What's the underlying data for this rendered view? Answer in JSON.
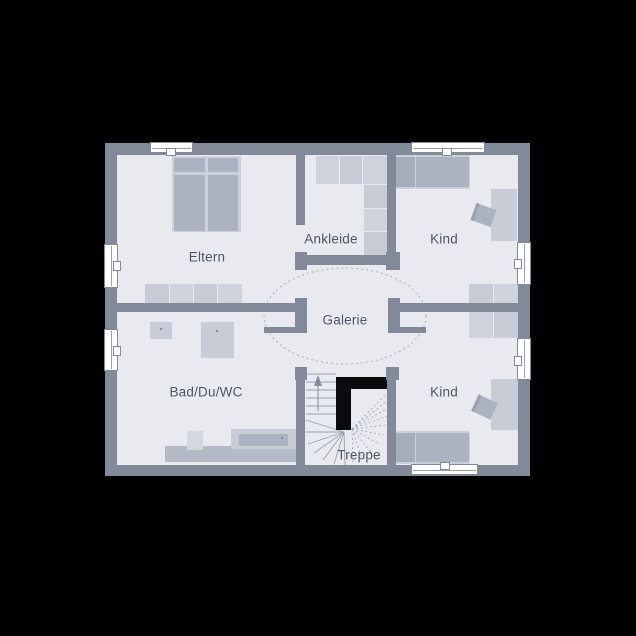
{
  "canvas": {
    "width": 636,
    "height": 636,
    "background": "#000000"
  },
  "plan": {
    "left": 105,
    "top": 143,
    "width": 425,
    "height": 333,
    "wall_thickness": 12,
    "colors": {
      "wall": "#828a99",
      "room": "#e8eaef",
      "furniture": "#c7ccd7",
      "furniture_alt": "#ced3dd",
      "furniture_dark": "#abb2c0",
      "furniture_darker": "#a5adbb",
      "bed_frame": "#cbd0db",
      "fixture_light": "#d2d7e0",
      "counter": "#b4bbc7",
      "stair_core": "#0b0b0d",
      "line": "#9aa1ae",
      "dash": "#a7aeb9",
      "text": "#4d5665",
      "window": "#ffffff"
    }
  },
  "rooms": {
    "eltern": {
      "label": "Eltern",
      "cx": 102,
      "cy": 114
    },
    "ankleide": {
      "label": "Ankleide",
      "cx": 226,
      "cy": 96
    },
    "kind_top": {
      "label": "Kind",
      "cx": 339,
      "cy": 96
    },
    "galerie": {
      "label": "Galerie",
      "cx": 240,
      "cy": 177
    },
    "bad": {
      "label": "Bad/Du/WC",
      "cx": 101,
      "cy": 249
    },
    "kind_bottom": {
      "label": "Kind",
      "cx": 339,
      "cy": 249
    },
    "treppe": {
      "label": "Treppe",
      "cx": 254,
      "cy": 312
    }
  },
  "walls": [
    {
      "name": "wall-eltern-east",
      "x": 191,
      "y": 12,
      "w": 9,
      "h": 70
    },
    {
      "name": "wall-ankleide-south",
      "x": 190,
      "y": 112,
      "w": 105,
      "h": 10
    },
    {
      "name": "wall-cap-ankleide-west",
      "x": 190,
      "y": 109,
      "w": 12,
      "h": 18
    },
    {
      "name": "wall-cap-ankleide-east",
      "x": 281,
      "y": 109,
      "w": 14,
      "h": 18
    },
    {
      "name": "wall-ankleide-east",
      "x": 282,
      "y": 12,
      "w": 9,
      "h": 97
    },
    {
      "name": "wall-cap-galerie-west",
      "x": 190,
      "y": 155,
      "w": 12,
      "h": 35
    },
    {
      "name": "wall-cap-galerie-east",
      "x": 283,
      "y": 155,
      "w": 12,
      "h": 35
    },
    {
      "name": "wall-divider-west",
      "x": 12,
      "y": 160,
      "w": 179,
      "h": 9
    },
    {
      "name": "wall-divider-east",
      "x": 294,
      "y": 160,
      "w": 119,
      "h": 9
    },
    {
      "name": "wall-stairwell-west",
      "x": 191,
      "y": 224,
      "w": 9,
      "h": 98
    },
    {
      "name": "wall-stairwell-west-cap",
      "x": 190,
      "y": 224,
      "w": 12,
      "h": 13
    },
    {
      "name": "wall-stairwell-east",
      "x": 282,
      "y": 224,
      "w": 9,
      "h": 98
    },
    {
      "name": "wall-stairwell-east-cap",
      "x": 281,
      "y": 224,
      "w": 13,
      "h": 13
    },
    {
      "name": "door-leaf-bad",
      "x": 159,
      "y": 184,
      "w": 36,
      "h": 6
    },
    {
      "name": "door-leaf-kind-bottom",
      "x": 286,
      "y": 184,
      "w": 35,
      "h": 6
    }
  ],
  "furniture": [
    {
      "name": "eltern-bed-frame",
      "x": 67,
      "y": 13,
      "w": 69,
      "h": 76,
      "color": "bed_frame"
    },
    {
      "name": "eltern-bed-pillow-left",
      "x": 69,
      "y": 15,
      "w": 31,
      "h": 14,
      "color": "furniture_dark"
    },
    {
      "name": "eltern-bed-pillow-right",
      "x": 103,
      "y": 15,
      "w": 30,
      "h": 14,
      "color": "furniture_dark"
    },
    {
      "name": "eltern-bed-mattress-left",
      "x": 69,
      "y": 32,
      "w": 31,
      "h": 56,
      "color": "furniture_dark"
    },
    {
      "name": "eltern-bed-mattress-right",
      "x": 103,
      "y": 32,
      "w": 30,
      "h": 56,
      "color": "furniture_dark"
    },
    {
      "name": "eltern-wardrobe-cell",
      "x": 40,
      "y": 141,
      "w": 24,
      "h": 24,
      "color": "furniture"
    },
    {
      "name": "eltern-wardrobe-cell",
      "x": 65,
      "y": 141,
      "w": 23,
      "h": 24,
      "color": "furniture_alt"
    },
    {
      "name": "eltern-wardrobe-cell",
      "x": 89,
      "y": 141,
      "w": 23,
      "h": 24,
      "color": "furniture"
    },
    {
      "name": "eltern-wardrobe-cell",
      "x": 113,
      "y": 141,
      "w": 24,
      "h": 24,
      "color": "furniture_alt"
    },
    {
      "name": "ankleide-wardrobe-cell",
      "x": 211,
      "y": 13,
      "w": 23,
      "h": 28,
      "color": "furniture_alt"
    },
    {
      "name": "ankleide-wardrobe-cell",
      "x": 235,
      "y": 13,
      "w": 22,
      "h": 28,
      "color": "furniture"
    },
    {
      "name": "ankleide-wardrobe-cell",
      "x": 258,
      "y": 13,
      "w": 24,
      "h": 28,
      "color": "furniture_alt"
    },
    {
      "name": "ankleide-wardrobe-cell",
      "x": 259,
      "y": 42,
      "w": 23,
      "h": 23,
      "color": "furniture"
    },
    {
      "name": "ankleide-wardrobe-cell",
      "x": 259,
      "y": 66,
      "w": 23,
      "h": 22,
      "color": "furniture_alt"
    },
    {
      "name": "ankleide-wardrobe-cell",
      "x": 259,
      "y": 89,
      "w": 23,
      "h": 23,
      "color": "furniture"
    },
    {
      "name": "kind-top-bed-frame",
      "x": 288,
      "y": 12,
      "w": 77,
      "h": 34,
      "color": "bed_frame"
    },
    {
      "name": "kind-top-bed-pillow",
      "x": 289,
      "y": 14,
      "w": 21,
      "h": 30,
      "color": "furniture_darker"
    },
    {
      "name": "kind-top-bed-mattress",
      "x": 311,
      "y": 14,
      "w": 53,
      "h": 30,
      "color": "furniture_dark"
    },
    {
      "name": "kind-top-desk",
      "x": 386,
      "y": 46,
      "w": 26,
      "h": 52,
      "color": "furniture"
    },
    {
      "name": "kind-top-chair",
      "x": 368,
      "y": 63,
      "w": 18,
      "h": 18,
      "color": "furniture_dark",
      "rotate": 20,
      "cls": "chair"
    },
    {
      "name": "kind-top-wardrobe-cell",
      "x": 364,
      "y": 141,
      "w": 24,
      "h": 24,
      "color": "furniture"
    },
    {
      "name": "kind-top-wardrobe-cell",
      "x": 389,
      "y": 141,
      "w": 24,
      "h": 24,
      "color": "furniture_alt"
    },
    {
      "name": "kind-bottom-wardrobe-cell",
      "x": 364,
      "y": 169,
      "w": 24,
      "h": 26,
      "color": "furniture_alt"
    },
    {
      "name": "kind-bottom-wardrobe-cell",
      "x": 389,
      "y": 169,
      "w": 24,
      "h": 26,
      "color": "furniture"
    },
    {
      "name": "kind-bottom-desk",
      "x": 386,
      "y": 236,
      "w": 27,
      "h": 51,
      "color": "furniture"
    },
    {
      "name": "kind-bottom-chair",
      "x": 369,
      "y": 255,
      "w": 18,
      "h": 18,
      "color": "furniture_dark",
      "rotate": 25,
      "cls": "chair"
    },
    {
      "name": "kind-bottom-bed-frame",
      "x": 288,
      "y": 288,
      "w": 77,
      "h": 33,
      "color": "bed_frame"
    },
    {
      "name": "kind-bottom-bed-pillow",
      "x": 289,
      "y": 290,
      "w": 21,
      "h": 29,
      "color": "furniture_darker"
    },
    {
      "name": "kind-bottom-bed-mattress",
      "x": 311,
      "y": 290,
      "w": 53,
      "h": 29,
      "color": "furniture_dark"
    },
    {
      "name": "bad-sink",
      "x": 45,
      "y": 179,
      "w": 22,
      "h": 17,
      "color": "furniture"
    },
    {
      "name": "bad-sink-drain-dot",
      "x": 55,
      "y": 185,
      "w": 2,
      "h": 2,
      "color": "wall"
    },
    {
      "name": "bad-shower",
      "x": 96,
      "y": 179,
      "w": 33,
      "h": 36,
      "color": "furniture"
    },
    {
      "name": "bad-shower-drain-dot",
      "x": 111,
      "y": 187,
      "w": 2,
      "h": 2,
      "color": "wall"
    },
    {
      "name": "bad-counter",
      "x": 60,
      "y": 303,
      "w": 131,
      "h": 16,
      "color": "counter"
    },
    {
      "name": "bad-toilet",
      "x": 82,
      "y": 288,
      "w": 16,
      "h": 19,
      "color": "fixture_light"
    },
    {
      "name": "bad-bathtub",
      "x": 126,
      "y": 286,
      "w": 65,
      "h": 20,
      "color": "furniture"
    },
    {
      "name": "bad-bathtub-inner",
      "x": 134,
      "y": 291,
      "w": 49,
      "h": 12,
      "color": "furniture_dark"
    },
    {
      "name": "bad-bathtub-drain-dot",
      "x": 176,
      "y": 294,
      "w": 2,
      "h": 2,
      "color": "wall"
    }
  ],
  "windows": [
    {
      "name": "window-top-eltern",
      "cls": "win win-h",
      "x": 46,
      "y": 0,
      "w": 41,
      "h": 9
    },
    {
      "name": "window-top-eltern-handle",
      "cls": "win-handle",
      "x": 62,
      "y": 6,
      "w": 8,
      "h": 6
    },
    {
      "name": "window-top-kind",
      "cls": "win win-h",
      "x": 307,
      "y": 0,
      "w": 72,
      "h": 9
    },
    {
      "name": "window-top-kind-handle",
      "cls": "win-handle",
      "x": 338,
      "y": 6,
      "w": 8,
      "h": 6
    },
    {
      "name": "window-bottom-kind",
      "cls": "win win-h",
      "x": 307,
      "y": 322,
      "w": 65,
      "h": 9
    },
    {
      "name": "window-bottom-kind-handle",
      "cls": "win-handle",
      "x": 336,
      "y": 320,
      "w": 8,
      "h": 6
    },
    {
      "name": "window-left-eltern",
      "cls": "win win-v",
      "x": 0,
      "y": 102,
      "w": 12,
      "h": 42
    },
    {
      "name": "window-left-eltern-handle",
      "cls": "win-handle",
      "x": 9,
      "y": 119,
      "w": 6,
      "h": 8
    },
    {
      "name": "window-left-bad",
      "cls": "win win-v",
      "x": 0,
      "y": 187,
      "w": 12,
      "h": 40
    },
    {
      "name": "window-left-bad-handle",
      "cls": "win-handle",
      "x": 9,
      "y": 204,
      "w": 6,
      "h": 8
    },
    {
      "name": "window-right-kind-top",
      "cls": "win win-v",
      "x": 413,
      "y": 100,
      "w": 12,
      "h": 41
    },
    {
      "name": "window-right-kind-top-handle",
      "cls": "win-handle",
      "x": 410,
      "y": 117,
      "w": 6,
      "h": 8
    },
    {
      "name": "window-right-kind-bottom",
      "cls": "win win-v",
      "x": 413,
      "y": 196,
      "w": 12,
      "h": 40
    },
    {
      "name": "window-right-kind-bottom-handle",
      "cls": "win-handle",
      "x": 410,
      "y": 214,
      "w": 6,
      "h": 8
    }
  ],
  "galerie_ellipse": {
    "cx": 240,
    "cy": 173,
    "rx": 81,
    "ry": 48
  }
}
